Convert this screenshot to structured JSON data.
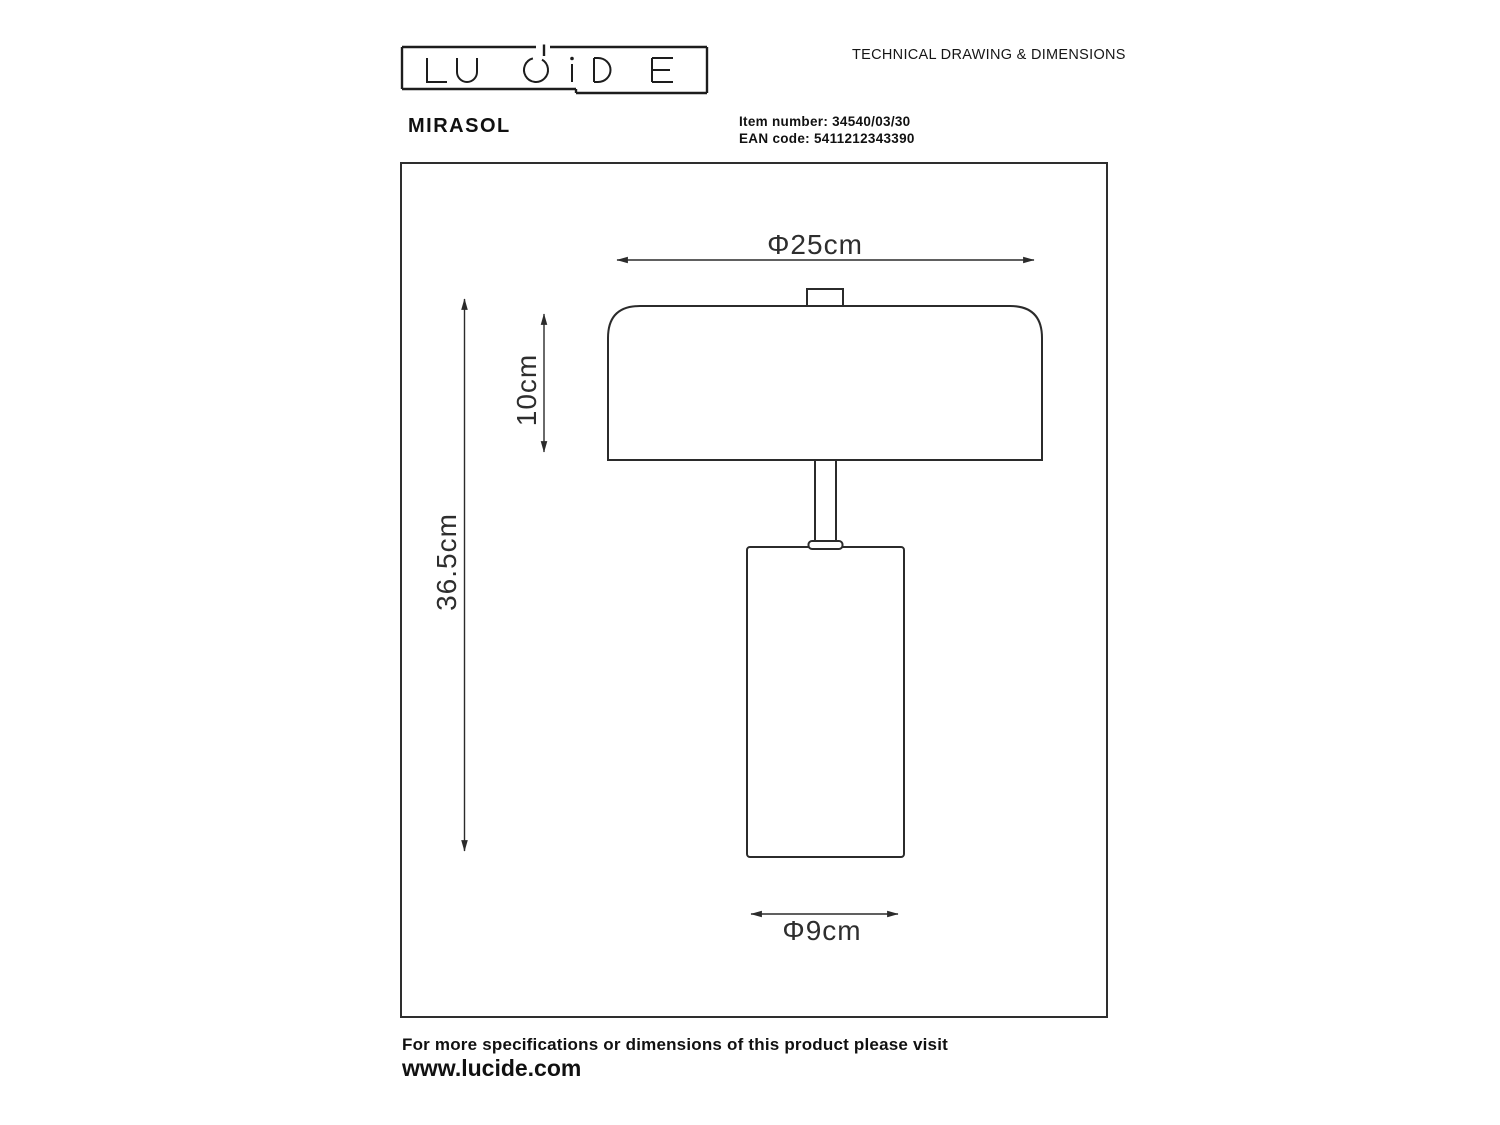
{
  "header": {
    "logo_text": "LUCIDE",
    "doc_title": "TECHNICAL DRAWING & DIMENSIONS",
    "product_name": "MIRASOL",
    "item_number_label": "Item number:",
    "item_number": "34540/03/30",
    "ean_label": "EAN code:",
    "ean_code": "5411212343390"
  },
  "drawing": {
    "dimensions": {
      "shade_diameter": "Φ25cm",
      "shade_height": "10cm",
      "total_height": "36.5cm",
      "base_diameter": "Φ9cm"
    }
  },
  "footer": {
    "note": "For more specifications or dimensions of this product please visit",
    "website": "www.lucide.com"
  },
  "colors": {
    "line": "#2b2b2b",
    "text": "#111111",
    "background": "#ffffff"
  }
}
